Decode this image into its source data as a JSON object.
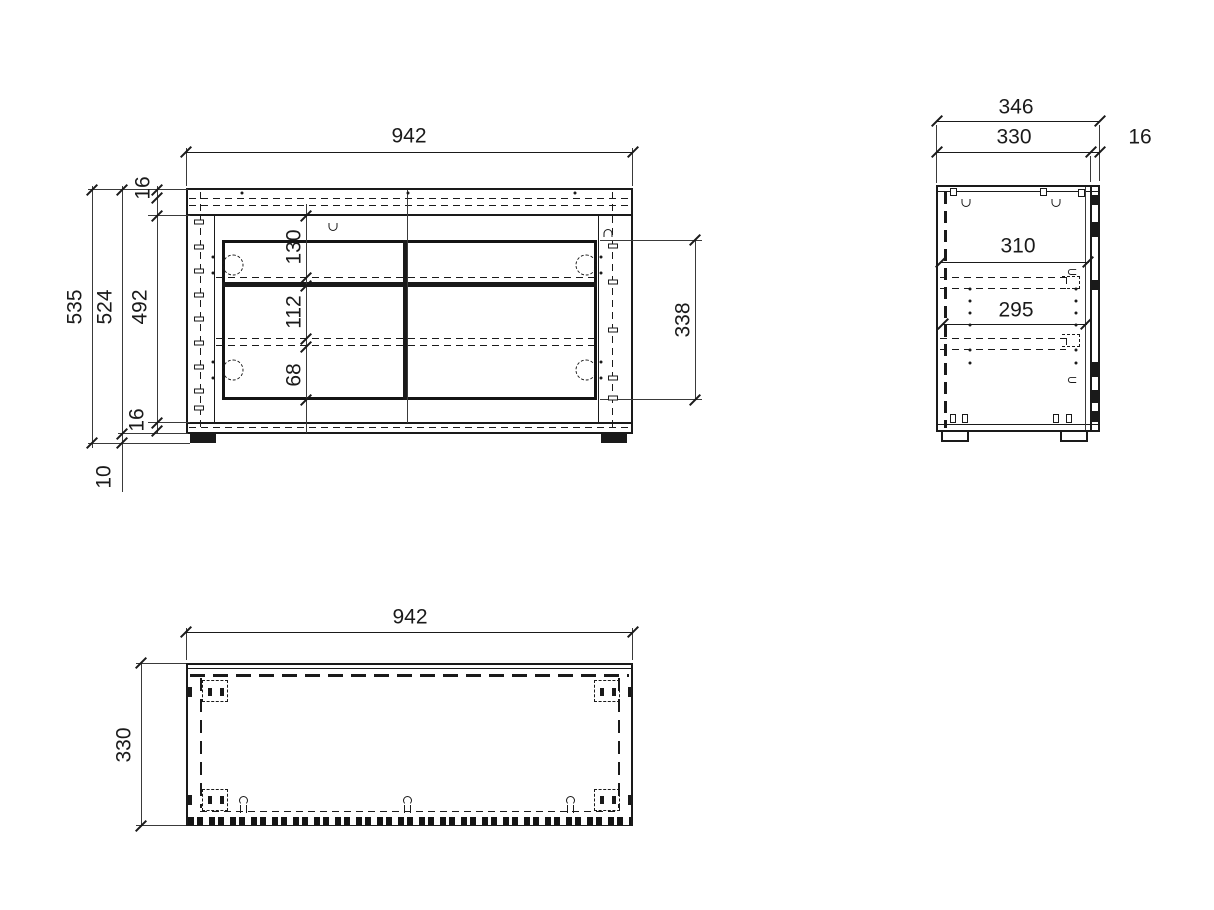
{
  "front": {
    "width": "942",
    "total_height": "535",
    "body_height": "524",
    "interior_height": "492",
    "top_panel": "16",
    "bottom_panel": "16",
    "feet_height": "10",
    "section_top": "130",
    "section_middle": "112",
    "section_bottom": "68",
    "opening_height": "338"
  },
  "side": {
    "total_depth": "346",
    "body_depth": "330",
    "front_panel": "16",
    "inner_depth_top": "310",
    "inner_depth_bottom": "295"
  },
  "plan": {
    "width": "942",
    "depth": "330"
  },
  "colors": {
    "line": "#1a1a1a",
    "background": "#ffffff"
  }
}
